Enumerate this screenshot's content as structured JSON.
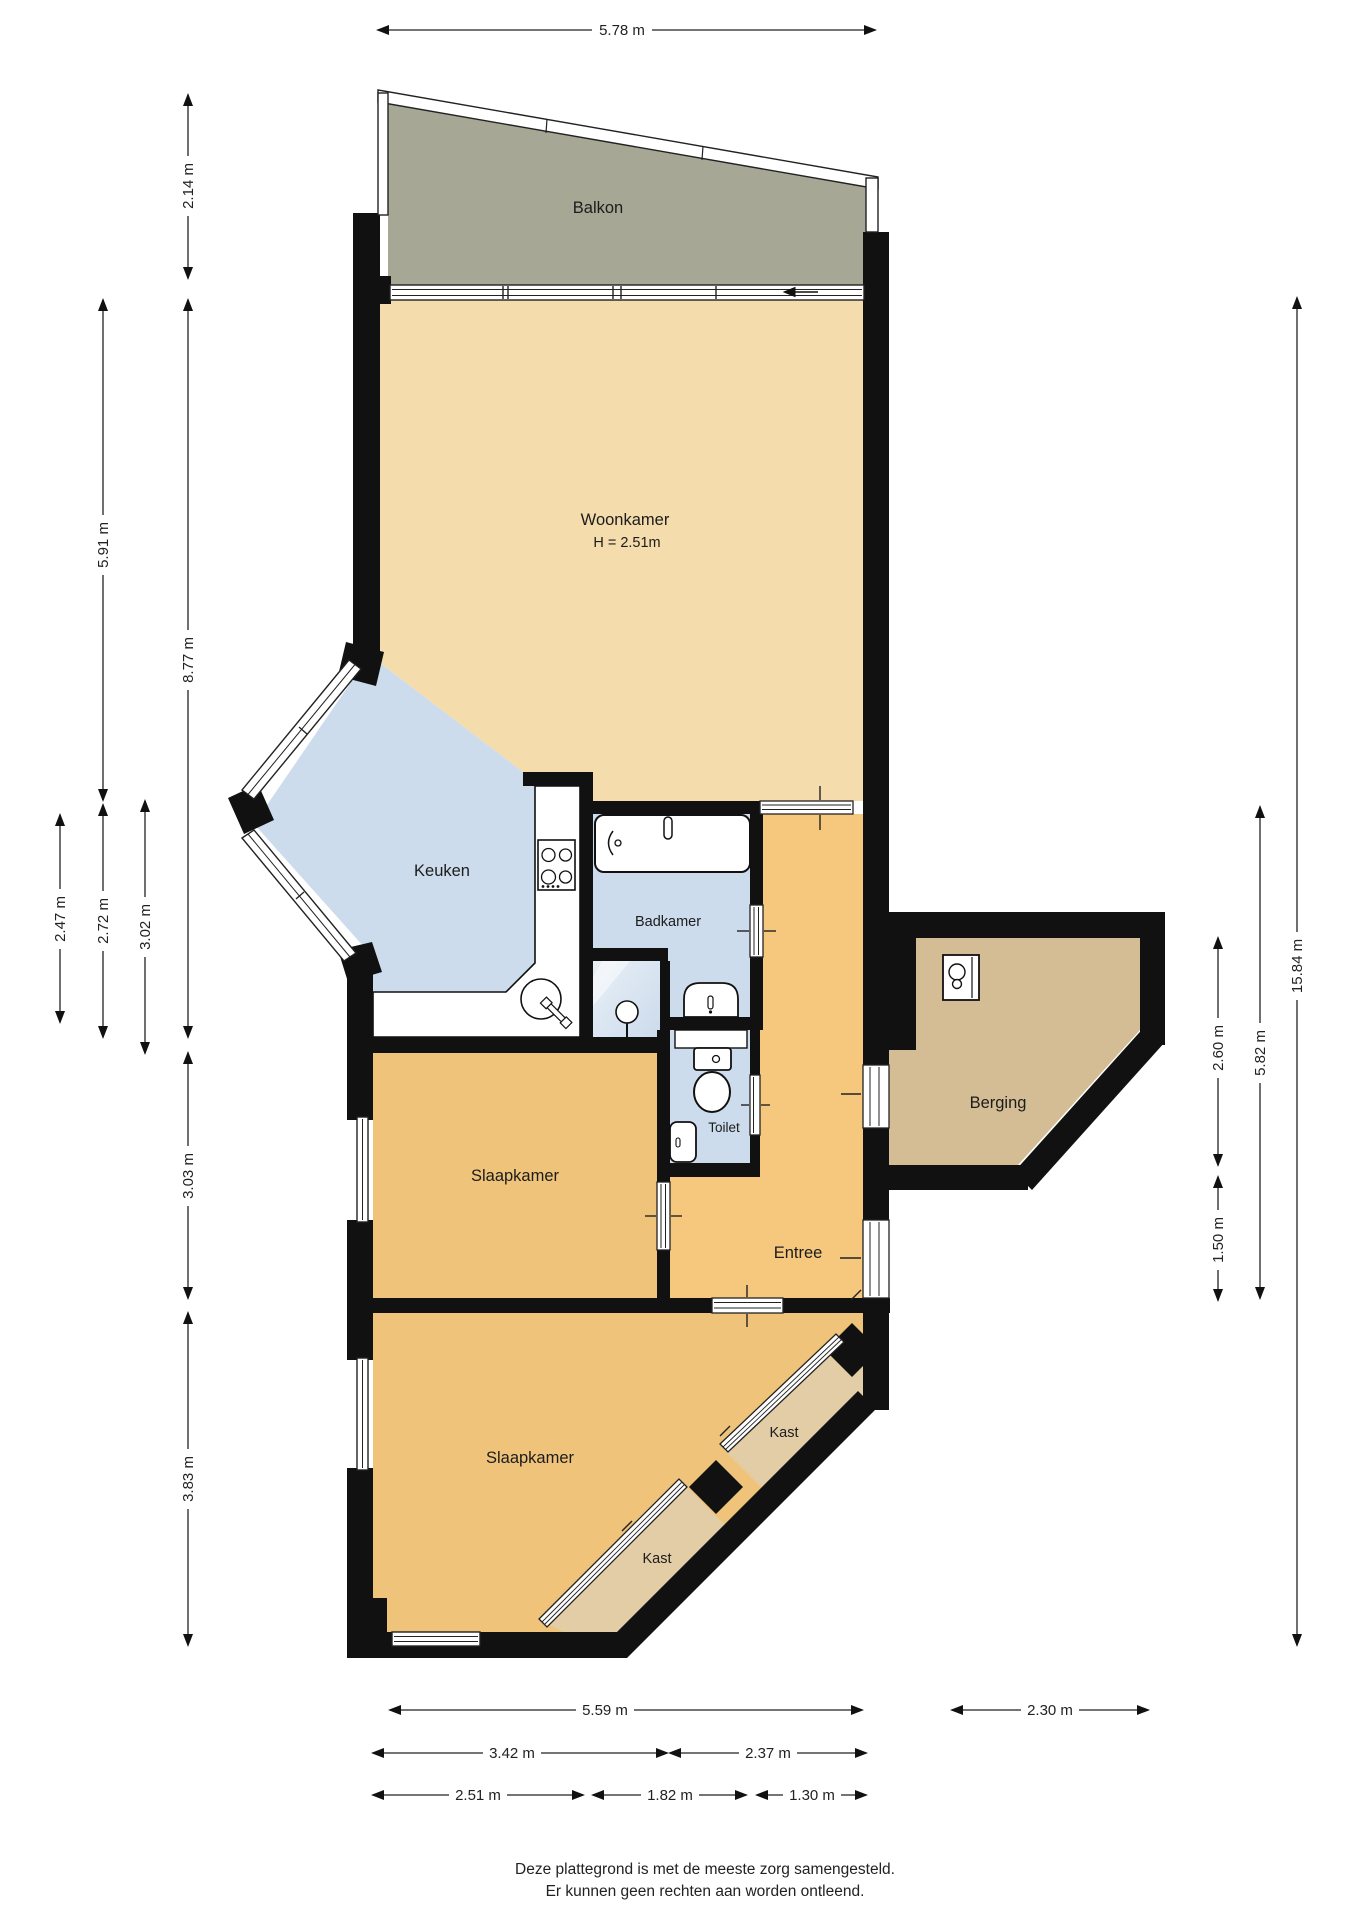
{
  "plan_type": "floorplan",
  "rooms": {
    "balkon": {
      "label": "Balkon"
    },
    "woonkamer": {
      "label": "Woonkamer",
      "ceiling_height": "H = 2.51m"
    },
    "keuken": {
      "label": "Keuken"
    },
    "badkamer": {
      "label": "Badkamer"
    },
    "toilet": {
      "label": "Toilet"
    },
    "slaapkamer_1": {
      "label": "Slaapkamer"
    },
    "slaapkamer_2": {
      "label": "Slaapkamer"
    },
    "entree": {
      "label": "Entree"
    },
    "berging": {
      "label": "Berging"
    },
    "kast_1": {
      "label": "Kast"
    },
    "kast_2": {
      "label": "Kast"
    }
  },
  "dimensions": {
    "top": [
      "5.78 m"
    ],
    "left": [
      "2.14 m",
      "8.77 m",
      "5.91 m",
      "2.72 m",
      "2.47 m",
      "3.02 m",
      "3.03 m",
      "3.83 m"
    ],
    "right": [
      "15.84 m",
      "5.82 m",
      "2.60 m",
      "1.50 m"
    ],
    "bottom": [
      "5.59 m",
      "2.30 m",
      "3.42 m",
      "2.37 m",
      "2.51 m",
      "1.82 m",
      "1.30 m"
    ]
  },
  "disclaimer": {
    "line1": "Deze plattegrond is met de meeste zorg samengesteld.",
    "line2": "Er kunnen geen rechten aan worden ontleend."
  },
  "colors": {
    "wall": "#111111",
    "living": "#f4dcad",
    "bedroom": "#f0c37a",
    "entree": "#f6c87e",
    "wet": "#cddcec",
    "shower": "#dde8f3",
    "balcony": "#a7a795",
    "storage": "#d4bd94",
    "closet": "#e3cda6",
    "dim": "#333333"
  }
}
